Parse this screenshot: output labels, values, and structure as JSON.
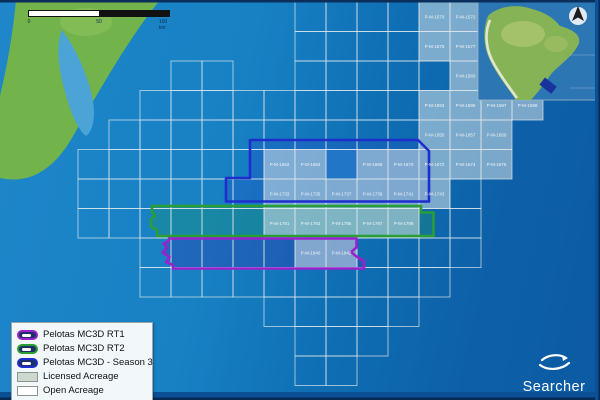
{
  "map": {
    "name": "Pelotas Basin multi-client 3D acreage map",
    "blocks": [
      {
        "label": "P-M-1570",
        "col": 11,
        "row": 0
      },
      {
        "label": "P-M-1572",
        "col": 12,
        "row": 0
      },
      {
        "label": "P-M-1575",
        "col": 11,
        "row": 1
      },
      {
        "label": "P-M-1577",
        "col": 12,
        "row": 1
      },
      {
        "label": "P-M-1583",
        "col": 12,
        "row": 2
      },
      {
        "label": "P-M-1593",
        "col": 11,
        "row": 3
      },
      {
        "label": "P-M-1595",
        "col": 12,
        "row": 3
      },
      {
        "label": "P-M-1597",
        "col": 13,
        "row": 3
      },
      {
        "label": "P-M-1599",
        "col": 14,
        "row": 3
      },
      {
        "label": "P-M-1655",
        "col": 11,
        "row": 4
      },
      {
        "label": "P-M-1657",
        "col": 12,
        "row": 4
      },
      {
        "label": "P-M-1659",
        "col": 13,
        "row": 4
      },
      {
        "label": "P-M-1662",
        "col": 6,
        "row": 5
      },
      {
        "label": "P-M-1664",
        "col": 7,
        "row": 5
      },
      {
        "label": "P-M-1668",
        "col": 9,
        "row": 5
      },
      {
        "label": "P-M-1670",
        "col": 10,
        "row": 5
      },
      {
        "label": "P-M-1672",
        "col": 11,
        "row": 5
      },
      {
        "label": "P-M-1674",
        "col": 12,
        "row": 5
      },
      {
        "label": "P-M-1676",
        "col": 13,
        "row": 5
      },
      {
        "label": "P-M-1733",
        "col": 6,
        "row": 6
      },
      {
        "label": "P-M-1735",
        "col": 7,
        "row": 6
      },
      {
        "label": "P-M-1737",
        "col": 8,
        "row": 6
      },
      {
        "label": "P-M-1739",
        "col": 9,
        "row": 6
      },
      {
        "label": "P-M-1741",
        "col": 10,
        "row": 6
      },
      {
        "label": "P-M-1743",
        "col": 11,
        "row": 6
      },
      {
        "label": "P-M-1791",
        "col": 6,
        "row": 7
      },
      {
        "label": "P-M-1793",
        "col": 7,
        "row": 7
      },
      {
        "label": "P-M-1795",
        "col": 8,
        "row": 7
      },
      {
        "label": "P-M-1797",
        "col": 9,
        "row": 7
      },
      {
        "label": "P-M-1799",
        "col": 10,
        "row": 7
      },
      {
        "label": "P-M-1840",
        "col": 7,
        "row": 8
      },
      {
        "label": "P-M-1842",
        "col": 8,
        "row": 8
      }
    ],
    "colors": {
      "rt1_purple": "#9a22cc",
      "rt2_green": "#2a9e35",
      "season3_blue": "#1d2ecc",
      "licensed_fill": "#cdd9ce",
      "open_fill": "#ffffff",
      "ocean_light": "#1b84c6",
      "ocean_dark": "#0c5ba4",
      "land_green": "#72b34b"
    }
  },
  "scale_bar": {
    "start": "0",
    "mid": "50",
    "end": "100 km"
  },
  "legend": {
    "items": [
      {
        "label": "Pelotas MC3D RT1",
        "swatch": "outline",
        "color": "#9a22cc"
      },
      {
        "label": "Pelotas MC3D RT2",
        "swatch": "outline",
        "color": "#2a9e35"
      },
      {
        "label": "Pelotas MC3D - Season 3",
        "swatch": "outline",
        "color": "#1d2ecc"
      },
      {
        "label": "Licensed Acreage",
        "swatch": "fill",
        "color": "#cdd9ce"
      },
      {
        "label": "Open Acreage",
        "swatch": "fill",
        "color": "#ffffff"
      }
    ]
  },
  "logo": {
    "text": "Searcher"
  }
}
